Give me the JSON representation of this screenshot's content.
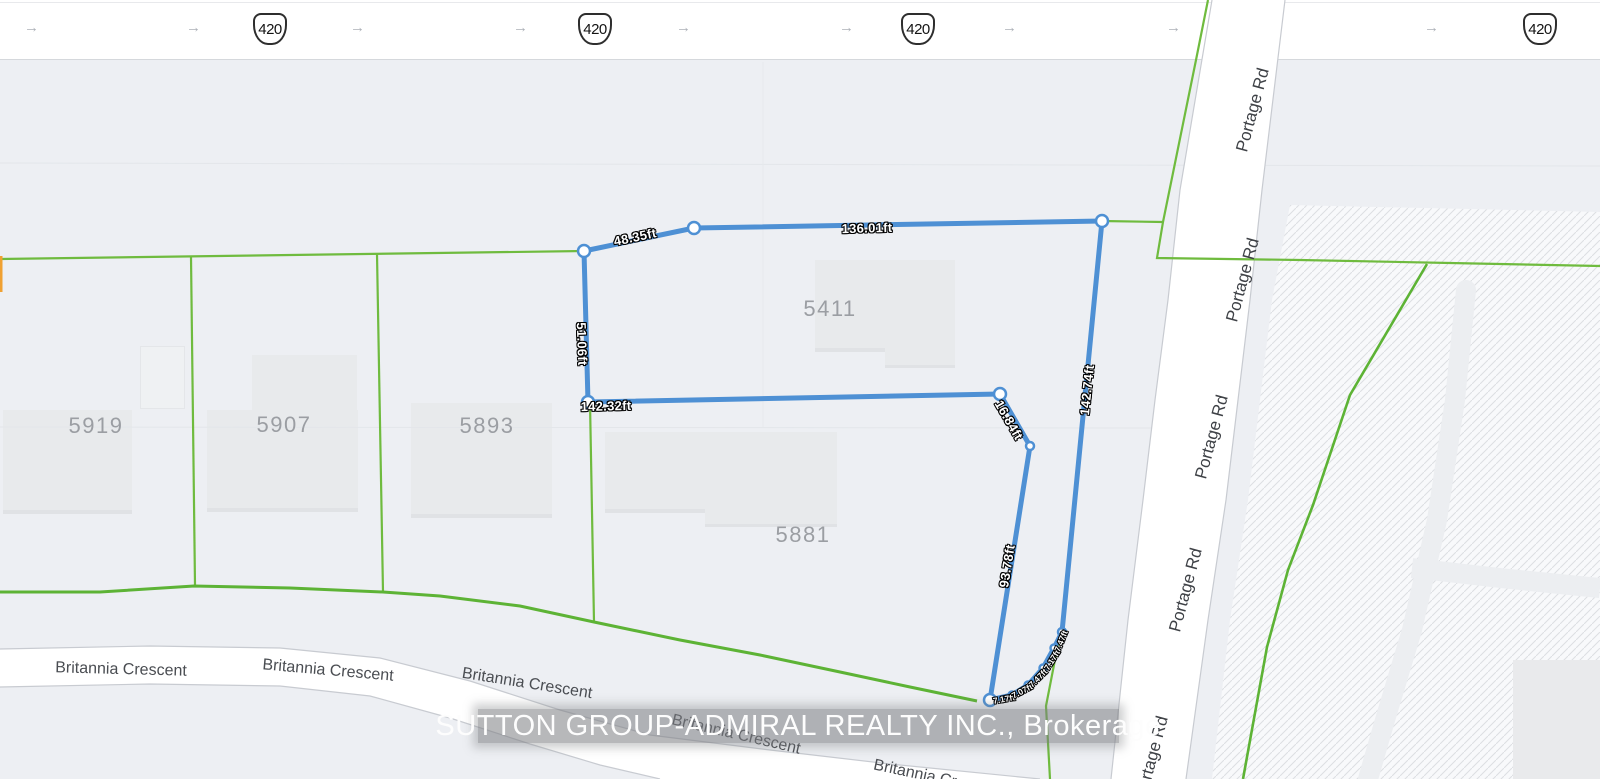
{
  "map": {
    "type": "property-survey-map",
    "background_color": "#edeff3",
    "parcel_line_color": "#6fbb3e",
    "survey_line_color": "#4e90d4"
  },
  "highway": {
    "shield_label": "420",
    "arrow_glyph": "→"
  },
  "roads": {
    "portage": "Portage Rd",
    "britannia": "Britannia Crescent"
  },
  "houses": [
    "5919",
    "5907",
    "5893",
    "5881",
    "5411"
  ],
  "survey": {
    "measurements": {
      "seg_top_left": "48.35ft",
      "seg_top": "136.01ft",
      "seg_left": "51.06ft",
      "seg_mid": "142.32ft",
      "seg_jog": "16.84ft",
      "seg_inner": "93.78ft",
      "seg_right": "142.74ft",
      "curve": [
        "7.17ft",
        "7.07ft",
        "7.47ft",
        "7.17ft",
        "7.47ft"
      ]
    }
  },
  "watermark": "SUTTON GROUP-ADMIRAL REALTY INC., Brokerage"
}
